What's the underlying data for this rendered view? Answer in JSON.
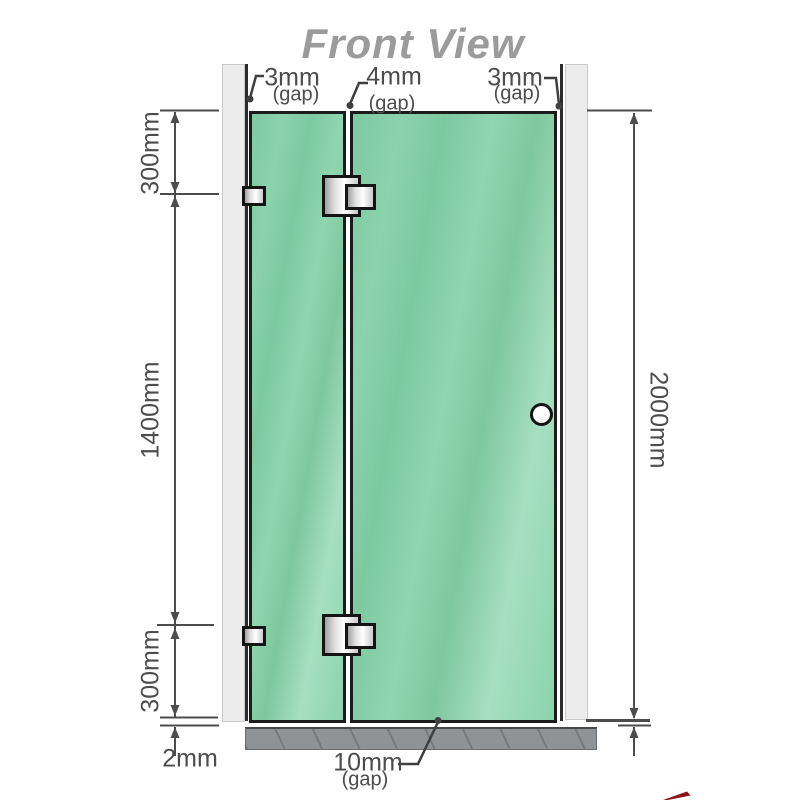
{
  "title": "Front View",
  "top_gap_labels": [
    {
      "value": "3mm",
      "sub": "(gap)"
    },
    {
      "value": "4mm",
      "sub": "(gap)"
    },
    {
      "value": "3mm",
      "sub": "(gap)"
    }
  ],
  "left_dimensions": {
    "top": "300mm",
    "middle": "1400mm",
    "bottom": "300mm",
    "floor_gap": "2mm"
  },
  "right_dimension": "2000mm",
  "bottom_gap": {
    "value": "10mm",
    "sub": "(gap)"
  },
  "colors": {
    "glass_green": "#84cfa6",
    "wall_gray": "#ececec",
    "base_gray": "#8f9396",
    "dimension_line": "#4c4c4c",
    "title_gray": "#9b9b9b",
    "hardware_metal": "#e0e0e0",
    "watermark_red": "#8c1420"
  }
}
